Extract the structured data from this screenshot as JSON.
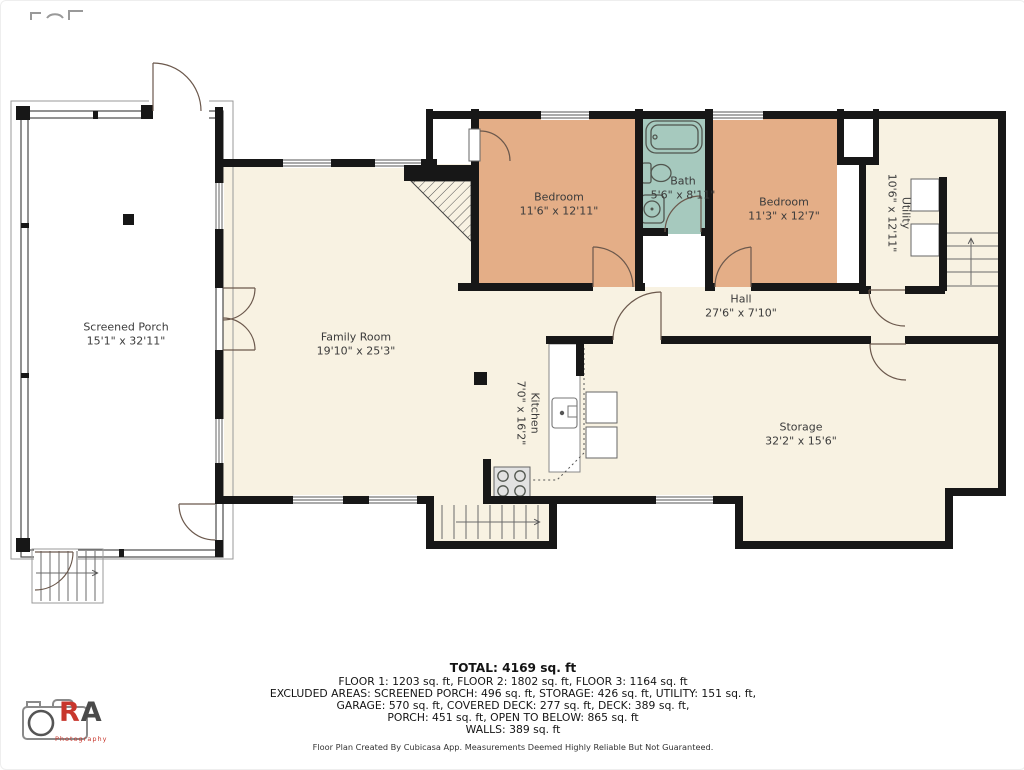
{
  "rooms": [
    {
      "id": "screened-porch",
      "name": "Screened Porch",
      "dims": "15'1\" x 32'11\""
    },
    {
      "id": "family-room",
      "name": "Family Room",
      "dims": "19'10\" x 25'3\""
    },
    {
      "id": "bedroom-1",
      "name": "Bedroom",
      "dims": "11'6\" x 12'11\""
    },
    {
      "id": "bath",
      "name": "Bath",
      "dims": "5'6\" x 8'11\""
    },
    {
      "id": "bedroom-2",
      "name": "Bedroom",
      "dims": "11'3\" x 12'7\""
    },
    {
      "id": "utility",
      "name": "Utility",
      "dims": "10'6\" x 12'11\""
    },
    {
      "id": "hall",
      "name": "Hall",
      "dims": "27'6\" x 7'10\""
    },
    {
      "id": "kitchen",
      "name": "Kitchen",
      "dims": "7'0\" x 16'2\""
    },
    {
      "id": "storage",
      "name": "Storage",
      "dims": "32'2\" x 15'6\""
    }
  ],
  "summary": {
    "total": "TOTAL: 4169 sq. ft",
    "floors": "FLOOR 1: 1203 sq. ft, FLOOR 2: 1802 sq. ft, FLOOR 3: 1164 sq. ft",
    "excluded_1": "EXCLUDED AREAS: SCREENED PORCH: 496 sq. ft, STORAGE: 426 sq. ft, UTILITY: 151 sq. ft,",
    "excluded_2": "GARAGE: 570 sq. ft, COVERED DECK: 277 sq. ft, DECK: 389 sq. ft,",
    "excluded_3": "PORCH: 451 sq. ft, OPEN TO BELOW: 865 sq. ft",
    "walls": "WALLS: 389 sq. ft",
    "disclaimer": "Floor Plan Created By Cubicasa App. Measurements Deemed Highly Reliable But Not Guaranteed."
  },
  "logo": {
    "text": "RA",
    "subtitle": "Photography"
  },
  "colors": {
    "wall": "#171717",
    "floor": "#f8f2e2",
    "bedroom": "#e4ae87",
    "bath": "#a6c9be",
    "logo_red": "#c8372d"
  }
}
